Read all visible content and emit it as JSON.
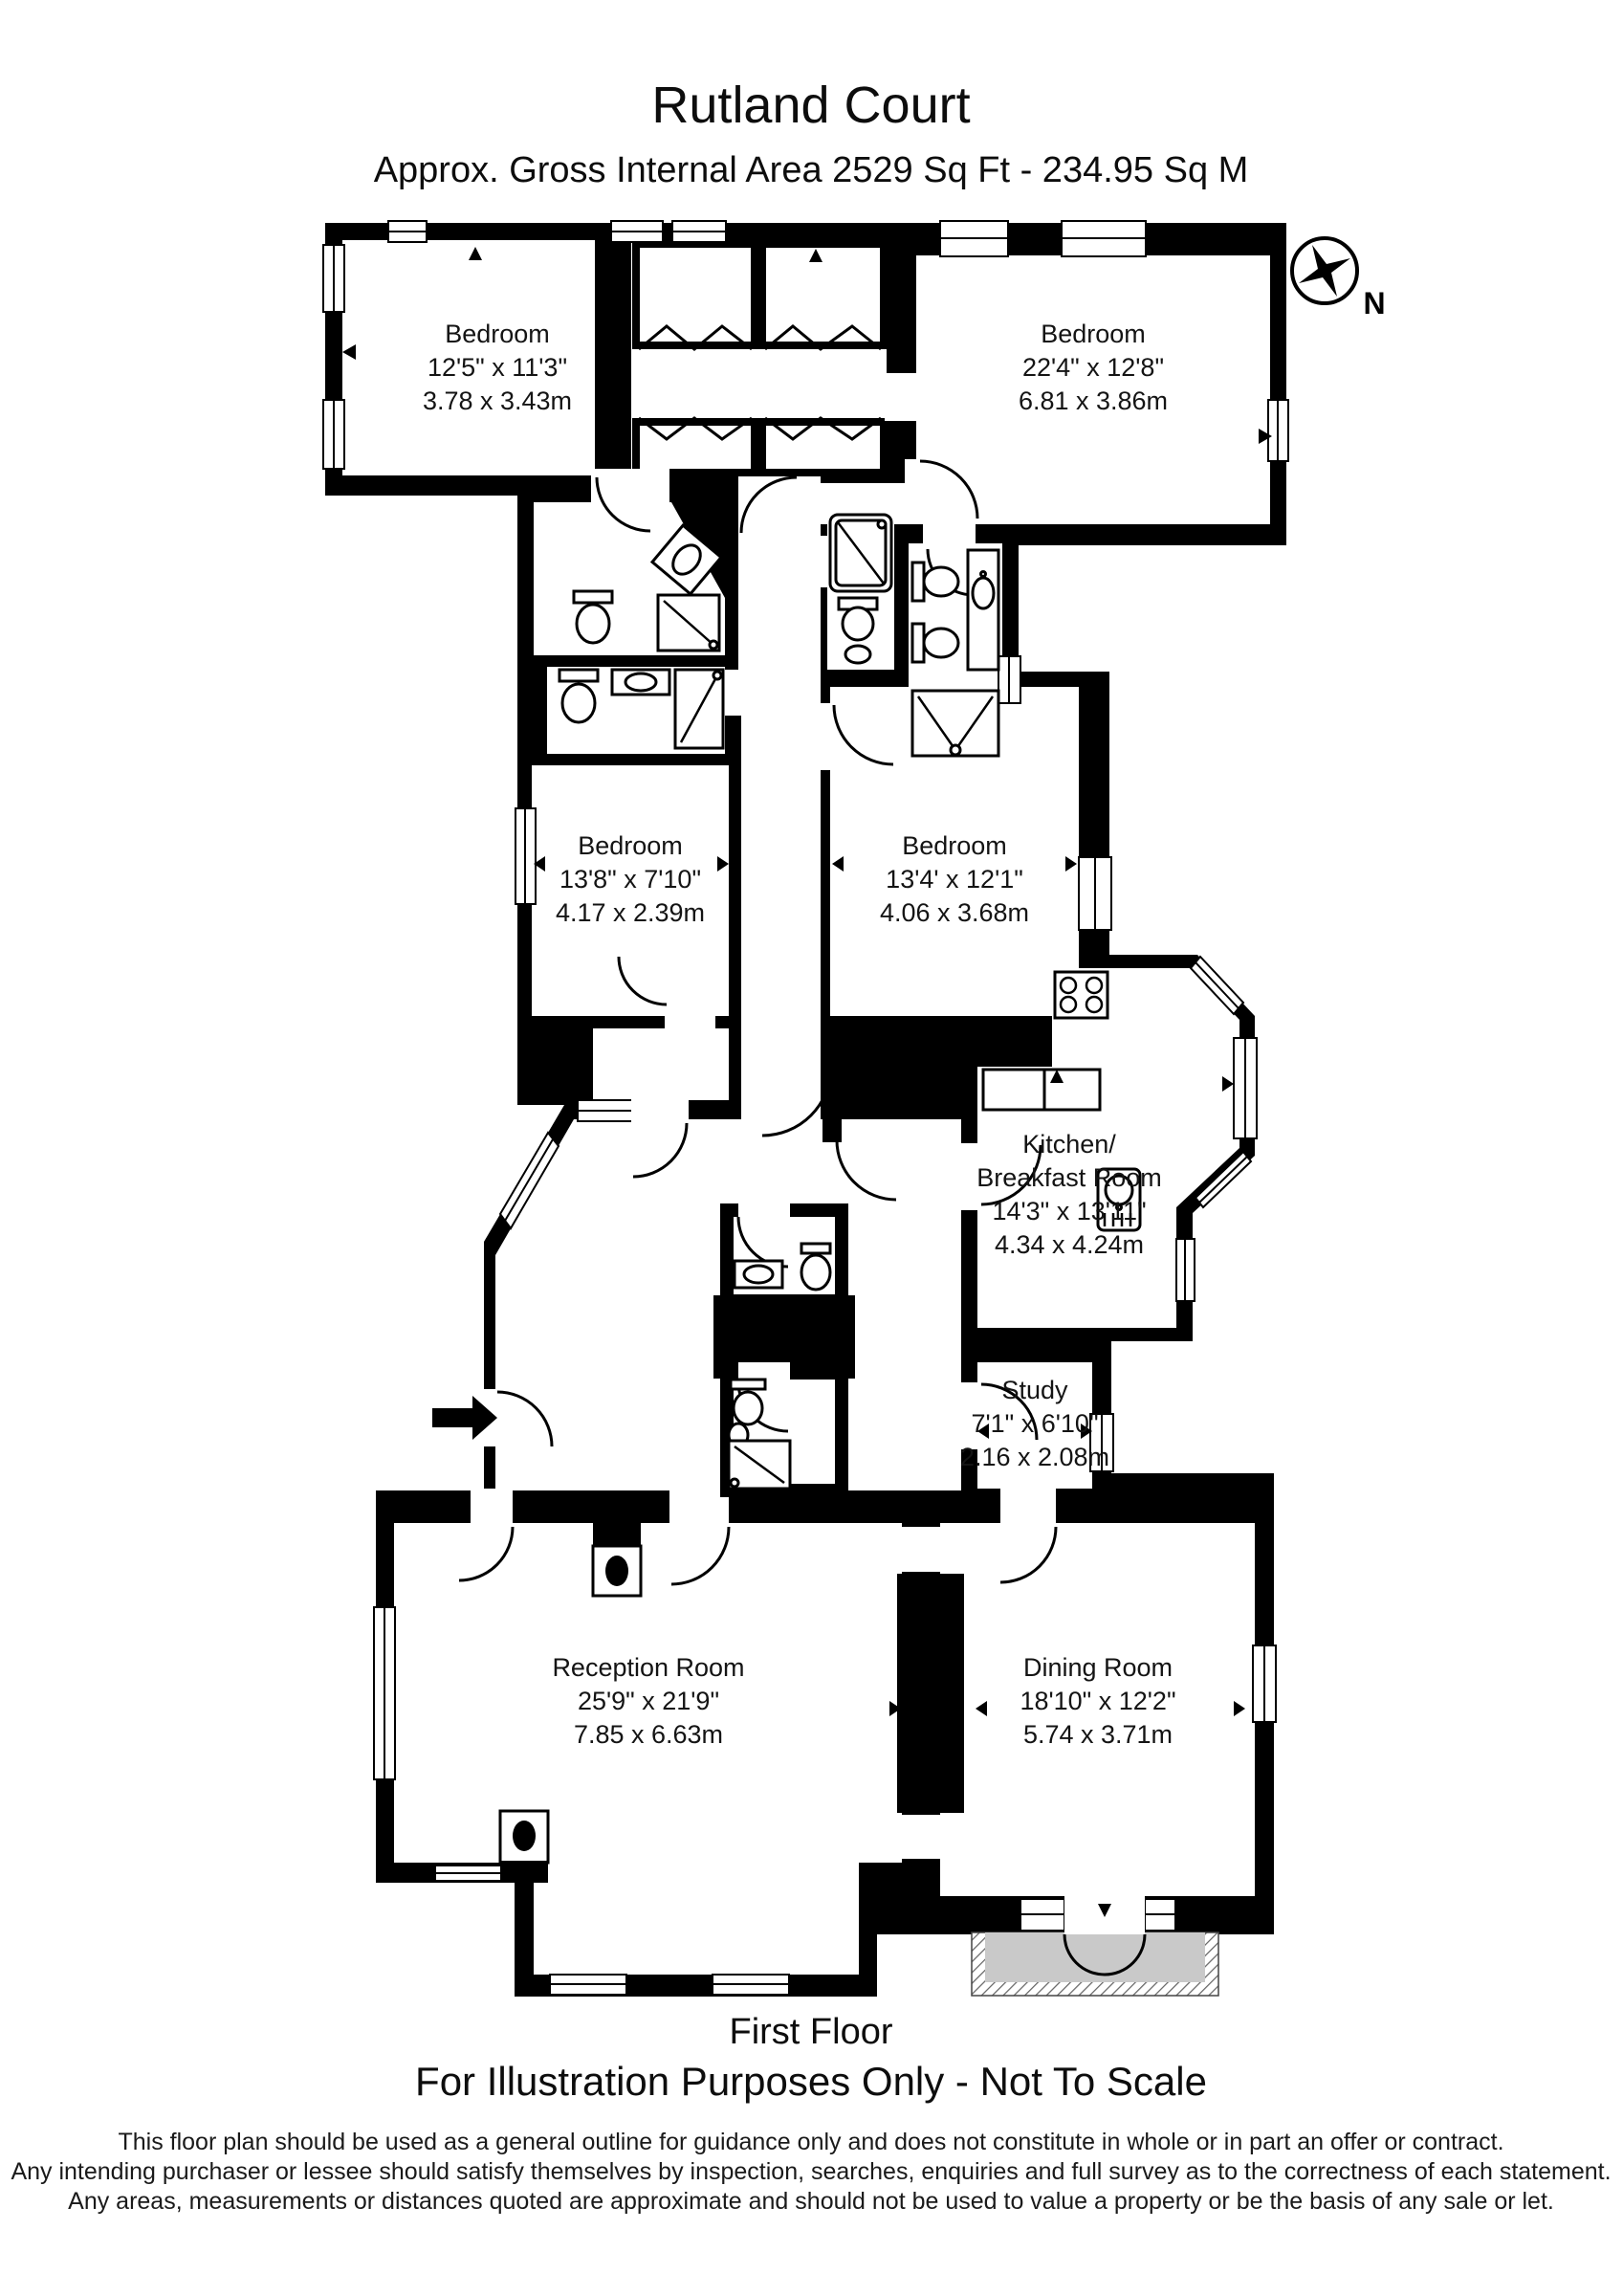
{
  "title": "Rutland Court",
  "subtitle": "Approx. Gross Internal Area  2529 Sq Ft  -  234.95 Sq M",
  "compass": {
    "north_label": "N"
  },
  "rooms": {
    "bedroom_top_left": {
      "name": "Bedroom",
      "imperial": "12'5\" x 11'3\"",
      "metric": "3.78 x 3.43m"
    },
    "bedroom_top_right": {
      "name": "Bedroom",
      "imperial": "22'4\" x 12'8\"",
      "metric": "6.81 x 3.86m"
    },
    "bedroom_mid_left": {
      "name": "Bedroom",
      "imperial": "13'8\" x 7'10\"",
      "metric": "4.17 x 2.39m"
    },
    "bedroom_mid_right": {
      "name": "Bedroom",
      "imperial": "13'4' x 12'1\"",
      "metric": "4.06 x 3.68m"
    },
    "kitchen": {
      "name": "Kitchen/",
      "name_line2": "Breakfast Room",
      "imperial": "14'3\" x 13'11\"",
      "metric": "4.34 x 4.24m"
    },
    "study": {
      "name": "Study",
      "imperial": "7'1\" x 6'10\"",
      "metric": "2.16 x 2.08m"
    },
    "reception": {
      "name": "Reception Room",
      "imperial": "25'9\" x 21'9\"",
      "metric": "7.85 x 6.63m"
    },
    "dining": {
      "name": "Dining Room",
      "imperial": "18'10\" x 12'2\"",
      "metric": "5.74 x 3.71m"
    }
  },
  "footer": {
    "floor_label": "First Floor",
    "scale_note": "For Illustration Purposes Only - Not To Scale",
    "disclaimer": [
      "This floor plan should be used as a general outline for guidance only and does not constitute in whole or in part an offer or contract.",
      "Any intending purchaser or lessee should satisfy themselves by inspection, searches, enquiries and full survey as to the correctness of each statement.",
      "Any areas, measurements or distances quoted are approximate and should not be used to value a property or be the basis of any sale or let."
    ]
  },
  "colors": {
    "wall": "#000000",
    "balcony_fill": "#c9c9c9",
    "page": "#ffffff"
  }
}
